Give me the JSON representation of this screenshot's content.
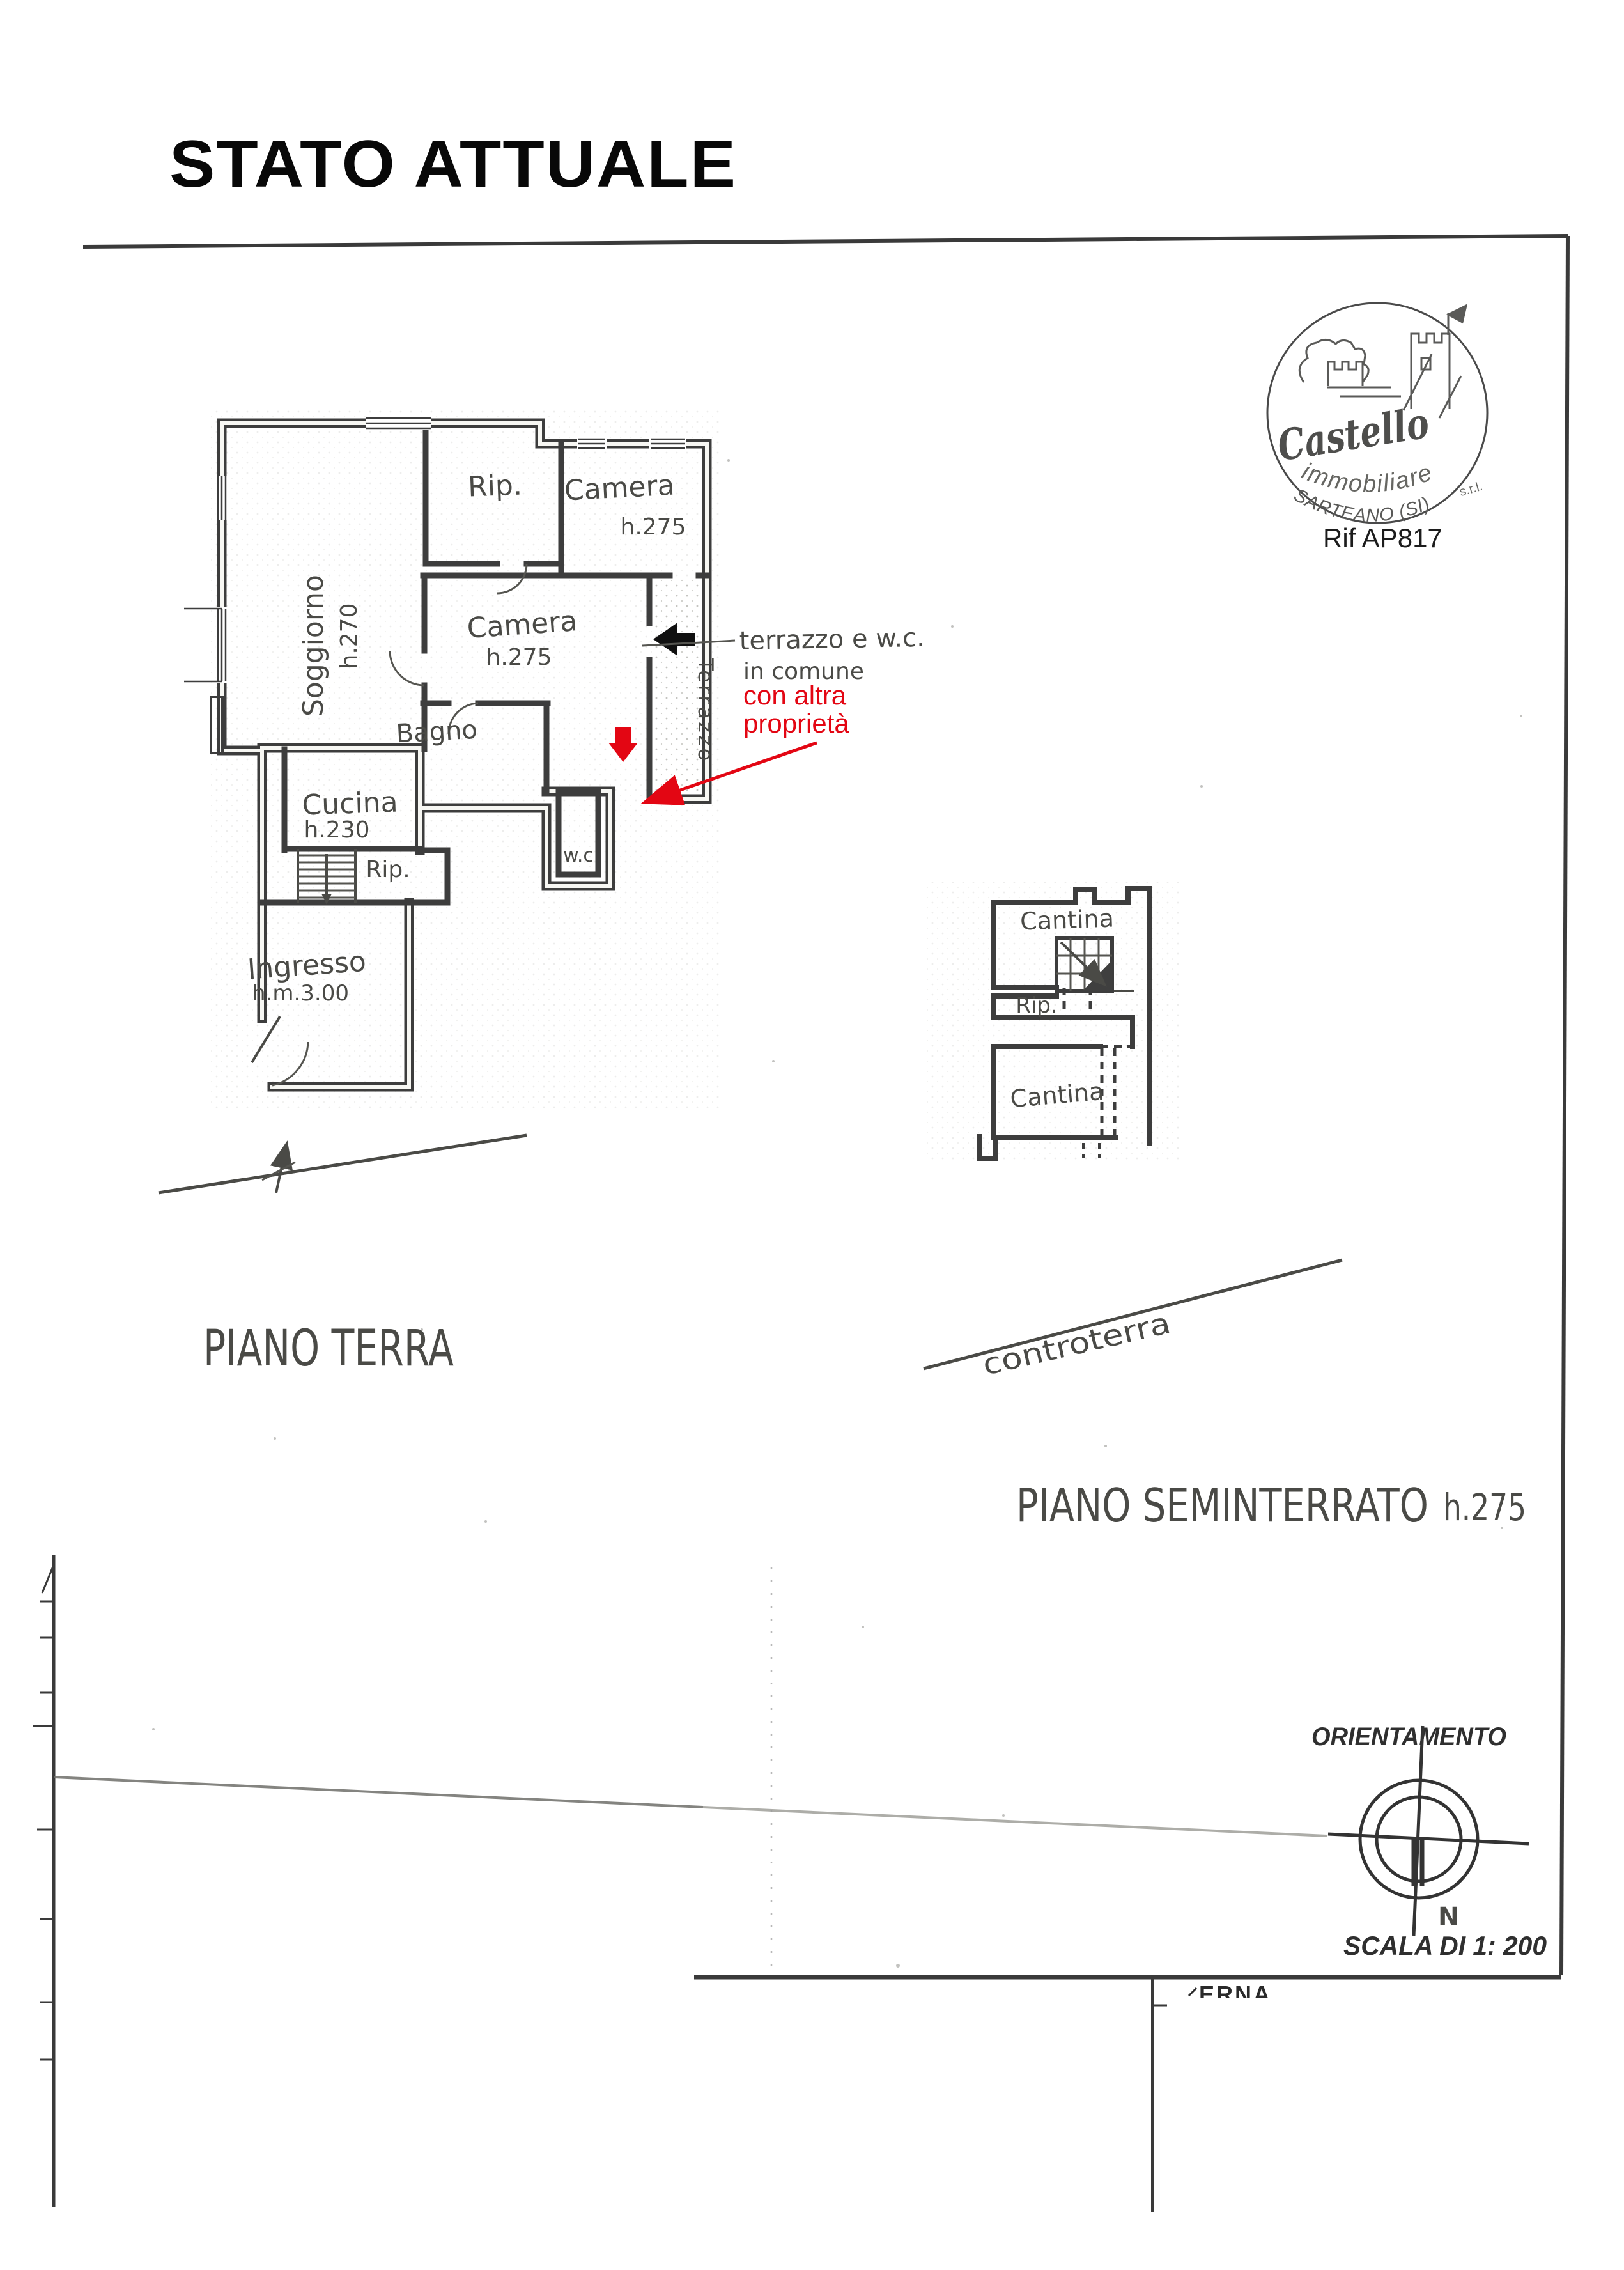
{
  "title": "STATO ATTUALE",
  "colors": {
    "annotation_red": "#e30613",
    "ink": "#3d3d3d"
  },
  "stamp": {
    "brand_script": "Castello",
    "brand_sub": "immobiliare",
    "brand_suffix": "s.r.l.",
    "brand_city": "SARTEANO (SI)",
    "reference": "Rif AP817"
  },
  "ground_floor": {
    "label": "PIANO TERRA",
    "rooms": {
      "soggiorno": "Soggiorno",
      "soggiorno_h": "h.270",
      "rip_top": "Rip.",
      "camera_top": "Camera",
      "camera_top_h": "h.275",
      "camera_mid": "Camera",
      "camera_mid_h": "h.275",
      "bagno": "Bagno",
      "terrazzo": "Terrazzo",
      "wc": "w.c",
      "cucina": "Cucina",
      "cucina_h": "h.230",
      "rip_low": "Rip.",
      "ingresso": "Ingresso",
      "ingresso_h": "h.m.3.00"
    },
    "note_line1": "terrazzo e w.c.",
    "note_line2": "in comune",
    "red_note_line1": "con altra",
    "red_note_line2": "proprietà"
  },
  "basement": {
    "label": "PIANO SEMINTERRATO",
    "label_h": "h.275",
    "cantina_top": "Cantina",
    "rip": "Rip.",
    "cantina_low": "Cantina",
    "ground_note": "controterra"
  },
  "compass": {
    "label": "ORIENTAMENTO",
    "north": "N"
  },
  "scale": {
    "label": "SCALA DI 1: 200"
  },
  "artifacts": {
    "fragment": "ERNA"
  }
}
